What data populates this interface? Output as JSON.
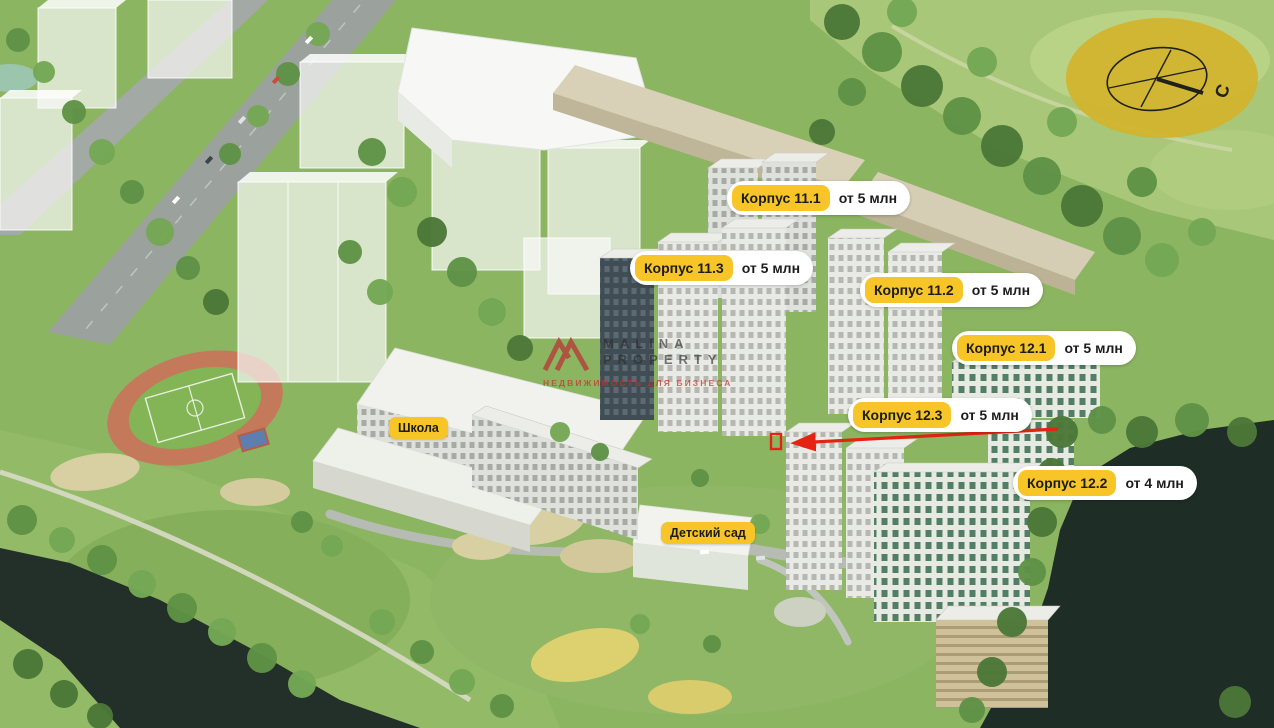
{
  "scene": {
    "description": "Aerial 3D render of residential complex masterplan with building labels",
    "labels": [
      {
        "id": "korpus-11-1",
        "name": "Корпус 11.1",
        "price": "от 5 млн"
      },
      {
        "id": "korpus-11-3",
        "name": "Корпус 11.3",
        "price": "от 5 млн"
      },
      {
        "id": "korpus-11-2",
        "name": "Корпус 11.2",
        "price": "от 5 млн"
      },
      {
        "id": "korpus-12-1",
        "name": "Корпус 12.1",
        "price": "от 5 млн"
      },
      {
        "id": "korpus-12-3",
        "name": "Корпус 12.3",
        "price": "от 5 млн"
      },
      {
        "id": "korpus-12-2",
        "name": "Корпус 12.2",
        "price": "от 4 млн"
      }
    ],
    "amenities": [
      {
        "id": "school",
        "label": "Школа"
      },
      {
        "id": "kindergarten",
        "label": "Детский сад"
      }
    ],
    "compass": {
      "north_label": "С"
    },
    "watermark": {
      "brand_line1": "MALINA",
      "brand_line2": "PROPERTY",
      "tagline": "НЕДВИЖИМОСТЬ ДЛЯ БИЗНЕСА"
    },
    "colors": {
      "badge_yellow": "#f7c527",
      "pill_white": "#ffffff",
      "label_text": "#1c1c1c",
      "arrow_red": "#e42313",
      "watermark_red": "#b5453c",
      "compass_yellow": "#d2b42c",
      "water_dark": "#1f2d27",
      "grass_green": "#8cb561"
    }
  }
}
